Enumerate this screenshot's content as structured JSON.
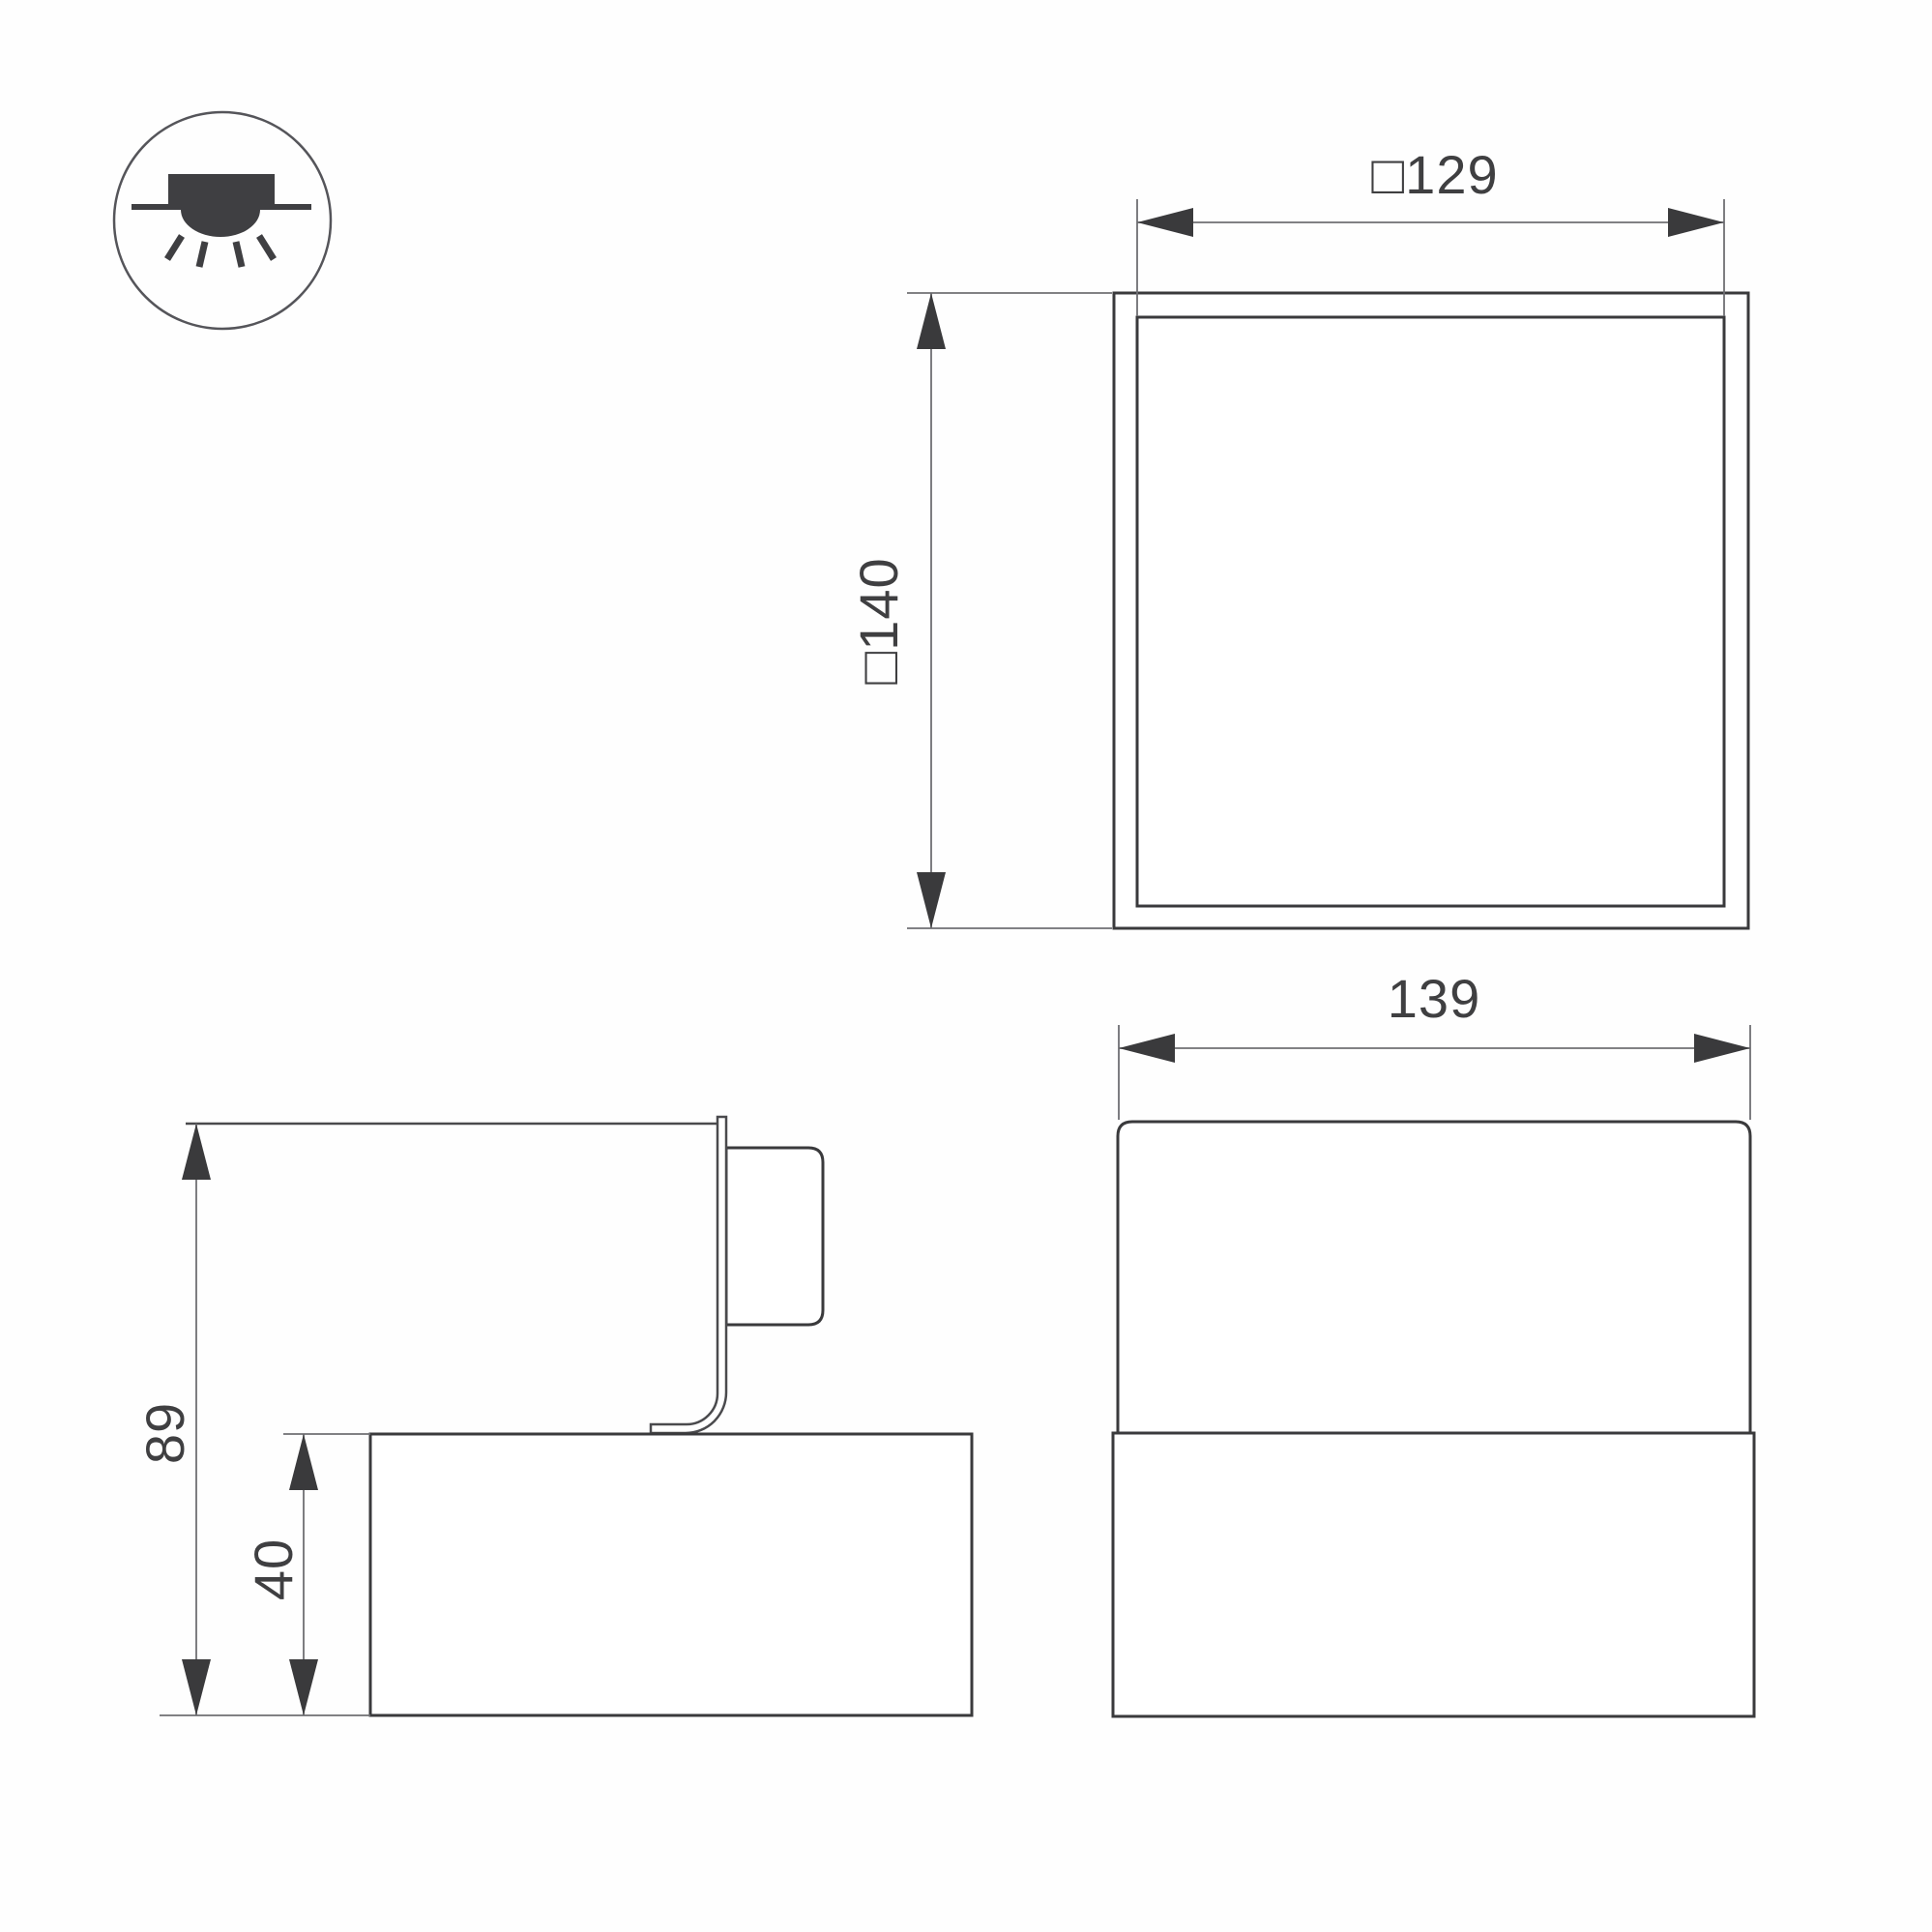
{
  "drawing_title": "luminaire-dimension-drawing",
  "colors": {
    "line": "#3a3a3c",
    "thin": "#6f6f73",
    "text": "#3f3f41",
    "bg": "#fefefe"
  },
  "legend": {
    "icon": "recessed-downlight-icon"
  },
  "views": {
    "top_view": {
      "outer_size_label": "□140",
      "inner_size_label": "□129"
    },
    "side_view": {
      "total_height_label": "89",
      "base_height_label": "40"
    },
    "front_view": {
      "width_label": "139"
    }
  }
}
